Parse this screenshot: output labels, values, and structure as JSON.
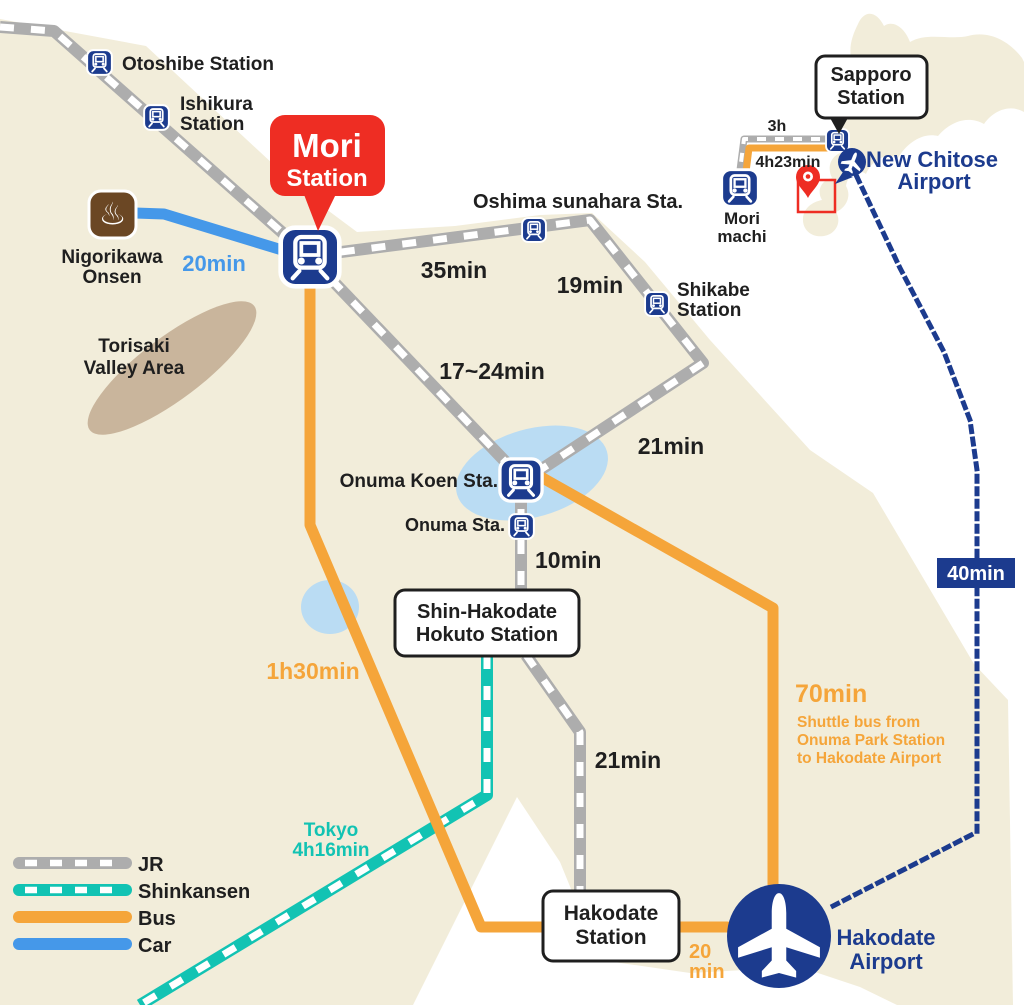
{
  "map": {
    "stations": {
      "otoshibe": {
        "label": "Otoshibe Station"
      },
      "ishikura": {
        "lines": [
          "Ishikura",
          "Station"
        ]
      },
      "mori": {
        "lines": [
          "Mori",
          "Station"
        ]
      },
      "oshima_sunahara": {
        "label": "Oshima sunahara Sta."
      },
      "shikabe": {
        "lines": [
          "Shikabe",
          "Station"
        ]
      },
      "onuma_koen": {
        "label": "Onuma Koen Sta."
      },
      "onuma": {
        "label": "Onuma Sta."
      },
      "shin_hakodate": {
        "lines": [
          "Shin-Hakodate",
          "Hokuto Station"
        ]
      },
      "hakodate": {
        "lines": [
          "Hakodate",
          "Station"
        ]
      }
    },
    "pois": {
      "nigorikawa_onsen": {
        "lines": [
          "Nigorikawa",
          "Onsen"
        ]
      },
      "torisaki": {
        "lines": [
          "Torisaki",
          "Valley Area"
        ]
      }
    },
    "airports": {
      "hakodate": {
        "lines": [
          "Hakodate",
          "Airport"
        ]
      },
      "new_chitose": {
        "lines": [
          "New Chitose",
          "Airport"
        ]
      }
    },
    "times": {
      "car_onsen_mori": "20min",
      "jr_mori_oshima": "35min",
      "jr_oshima_shikabe": "19min",
      "jr_mori_onuma": "17~24min",
      "jr_shikabe_onuma": "21min",
      "jr_onuma_shin_hakodate": "10min",
      "jr_shin_hakodate_hakodate": "21min",
      "bus_mori_hakodate": "1h30min",
      "shinkansen_tokyo": [
        "Tokyo",
        "4h16min"
      ],
      "bus_hakodate_airport": [
        "20",
        "min"
      ],
      "bus_shuttle": "70min",
      "bus_shuttle_note": [
        "Shuttle bus from",
        "Onuma Park Station",
        "to Hakodate Airport"
      ],
      "flight_chitose_hakodate": "40min"
    },
    "inset": {
      "sapporo": {
        "lines": [
          "Sapporo",
          "Station"
        ]
      },
      "mori_machi": {
        "lines": [
          "Mori",
          "machi"
        ]
      },
      "jr_time": "3h",
      "bus_time": "4h23min"
    },
    "legend": {
      "items": [
        {
          "label": "JR"
        },
        {
          "label": "Shinkansen"
        },
        {
          "label": "Bus"
        },
        {
          "label": "Car"
        }
      ]
    },
    "icons": {
      "onsen_glyph": "♨"
    },
    "colors": {
      "land": "#f2edda",
      "sea": "#ffffff",
      "lake": "#badcf3",
      "valley": "#c9b59c",
      "jr": "#adadad",
      "shinkansen": "#12c3b3",
      "bus": "#f5a53a",
      "car": "#4598e9",
      "navy": "#1c3b8e",
      "red": "#ee2d23",
      "onsen_brown": "#6b4724"
    }
  }
}
